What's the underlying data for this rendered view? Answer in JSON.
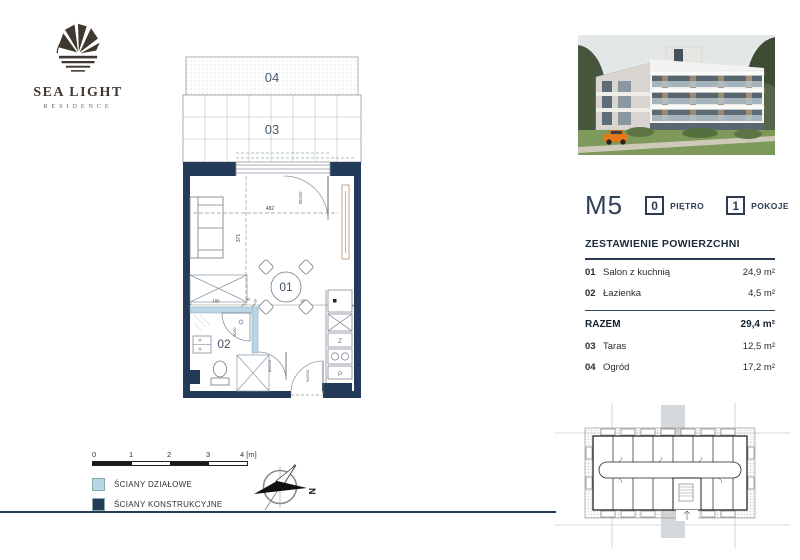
{
  "brand": {
    "name": "SEA LIGHT",
    "subtitle": "RESIDENCE"
  },
  "unit": {
    "code": "M5",
    "floor": {
      "value": "0",
      "label": "PIĘTRO"
    },
    "rooms": {
      "value": "1",
      "label": "POKOJE"
    }
  },
  "areas": {
    "heading": "ZESTAWIENIE POWIERZCHNI",
    "rows": [
      {
        "num": "01",
        "name": "Salon z kuchnią",
        "value": "24,9 m²"
      },
      {
        "num": "02",
        "name": "Łazienka",
        "value": "4,5 m²"
      }
    ],
    "total": {
      "label": "RAZEM",
      "value": "29,4 m²"
    },
    "extras": [
      {
        "num": "03",
        "name": "Taras",
        "value": "12,5 m²"
      },
      {
        "num": "04",
        "name": "Ogród",
        "value": "17,2 m²"
      }
    ]
  },
  "plan": {
    "labels": {
      "garden": "04",
      "terrace": "03",
      "living": "01",
      "bath": "02"
    },
    "dims": {
      "width": "482",
      "height": "371",
      "segments": [
        "188",
        "40",
        "8",
        "286"
      ]
    },
    "doors": {
      "balcony": "90/200",
      "bath": "80/200",
      "entry": "90/200",
      "shower": "90/90"
    },
    "kitchen": {
      "fridge": "Z",
      "washer": "P"
    }
  },
  "legend": {
    "scale": [
      "0",
      "1",
      "2",
      "3",
      "4 [m]"
    ],
    "items": [
      {
        "label": "ŚCIANY DZIAŁOWE",
        "color": "#b9d6e4"
      },
      {
        "label": "ŚCIANY KONSTRUKCYJNE",
        "color": "#253c59"
      }
    ]
  },
  "compass": {
    "north": "N"
  },
  "colors": {
    "wall": "#233b58",
    "partition": "#b9d6e4",
    "accent": "#2b3c52",
    "logo": "#3f382f"
  }
}
